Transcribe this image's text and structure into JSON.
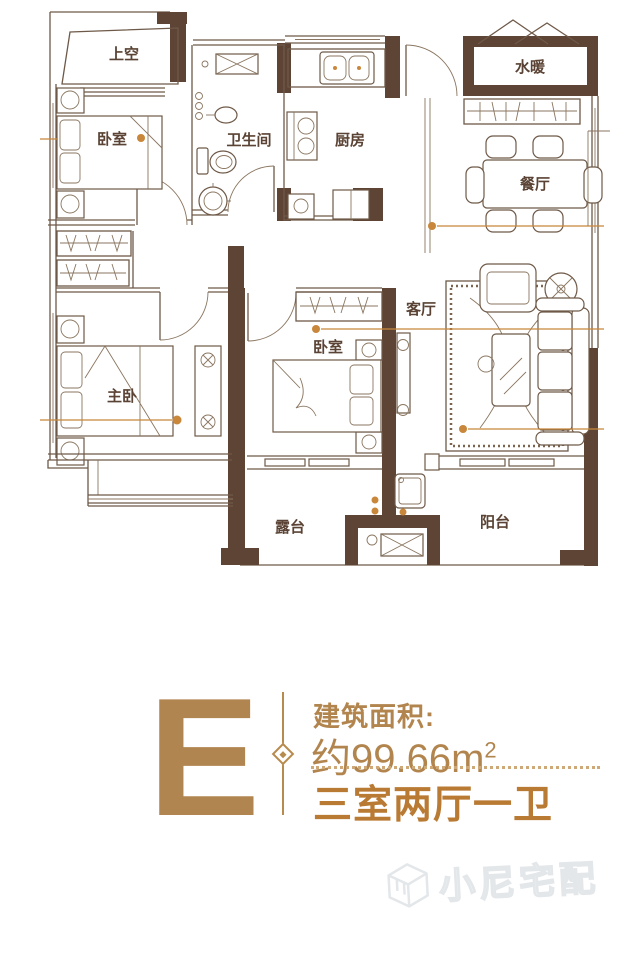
{
  "floor_plan": {
    "rooms": [
      {
        "id": "void-space",
        "label": "上空"
      },
      {
        "id": "bedroom-top",
        "label": "卧室"
      },
      {
        "id": "bathroom",
        "label": "卫生间"
      },
      {
        "id": "kitchen",
        "label": "厨房"
      },
      {
        "id": "water-heating",
        "label": "水暖"
      },
      {
        "id": "dining-room",
        "label": "餐厅"
      },
      {
        "id": "living-room",
        "label": "客厅"
      },
      {
        "id": "bedroom-mid",
        "label": "卧室"
      },
      {
        "id": "master-bedroom",
        "label": "主卧"
      },
      {
        "id": "terrace",
        "label": "露台"
      },
      {
        "id": "balcony",
        "label": "阳台"
      }
    ]
  },
  "unit_info": {
    "unit_letter": "E",
    "area_title": "建筑面积:",
    "area_value": "约99.66m",
    "area_unit_superscript": "2",
    "layout_summary": "三室两厅一卫"
  },
  "watermark": {
    "brand_text": "小尼宅配"
  },
  "colors": {
    "wall_brown": "#5e4434",
    "line_brown": "#6e5948",
    "gold_text": "#b2854e",
    "layout_accent": "#b97a33",
    "dimension_orange": "#c8873b"
  }
}
